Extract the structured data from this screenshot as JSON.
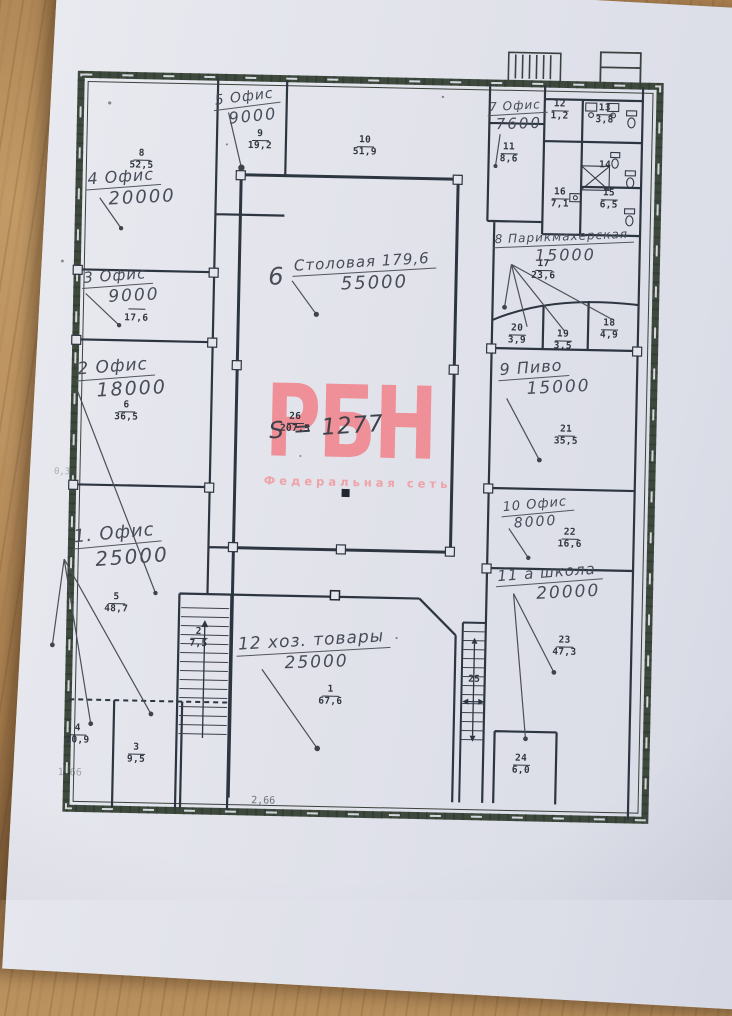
{
  "watermark": {
    "text": "РБН",
    "subtext": "Федеральная сеть",
    "color": "#ef8f97"
  },
  "plan": {
    "total_area": "S = 1277",
    "dims": {
      "d1": "2,66",
      "d2": "1,66",
      "d3": "0,39"
    },
    "annotations": [
      {
        "label": "1. Офис",
        "value": "25000"
      },
      {
        "label": "2 Офис",
        "value": "18000"
      },
      {
        "label": "3 Офис",
        "value": "9000"
      },
      {
        "label": "4 Офис",
        "value": "20000"
      },
      {
        "label": "5 Офис",
        "value": "9000"
      },
      {
        "num": "6",
        "label": "Столовая 179,6",
        "value": "55000"
      },
      {
        "label": "7 Офис",
        "value": "7600"
      },
      {
        "label": "8 Парикмахерская",
        "value": "15000"
      },
      {
        "label": "9 Пиво",
        "value": "15000"
      },
      {
        "label": "10 Офис",
        "value": "8000"
      },
      {
        "label": "11 а школа",
        "value": "20000"
      },
      {
        "label": "12 хоз. товары",
        "value": "25000"
      }
    ],
    "rooms": [
      {
        "num": "1",
        "area": "67,6"
      },
      {
        "num": "2",
        "area": "7,5"
      },
      {
        "num": "3",
        "area": "9,5"
      },
      {
        "num": "4",
        "area": "10,9"
      },
      {
        "num": "5",
        "area": "48,7"
      },
      {
        "num": "6",
        "area": "36,5"
      },
      {
        "num": "",
        "area": "17,6"
      },
      {
        "num": "8",
        "area": "52,5"
      },
      {
        "num": "9",
        "area": "19,2"
      },
      {
        "num": "10",
        "area": "51,9"
      },
      {
        "num": "11",
        "area": "8,6"
      },
      {
        "num": "12",
        "area": "1,2"
      },
      {
        "num": "13",
        "area": "3,8"
      },
      {
        "num": "14",
        "area": ""
      },
      {
        "num": "15",
        "area": "6,5"
      },
      {
        "num": "16",
        "area": "7,1"
      },
      {
        "num": "17",
        "area": "23,6"
      },
      {
        "num": "18",
        "area": "4,9"
      },
      {
        "num": "19",
        "area": "3,5"
      },
      {
        "num": "20",
        "area": "3,9"
      },
      {
        "num": "21",
        "area": "35,5"
      },
      {
        "num": "22",
        "area": "16,6"
      },
      {
        "num": "23",
        "area": "47,3"
      },
      {
        "num": "24",
        "area": "6,0"
      },
      {
        "num": "25",
        "area": ""
      },
      {
        "num": "26",
        "area": "207,5"
      }
    ]
  }
}
